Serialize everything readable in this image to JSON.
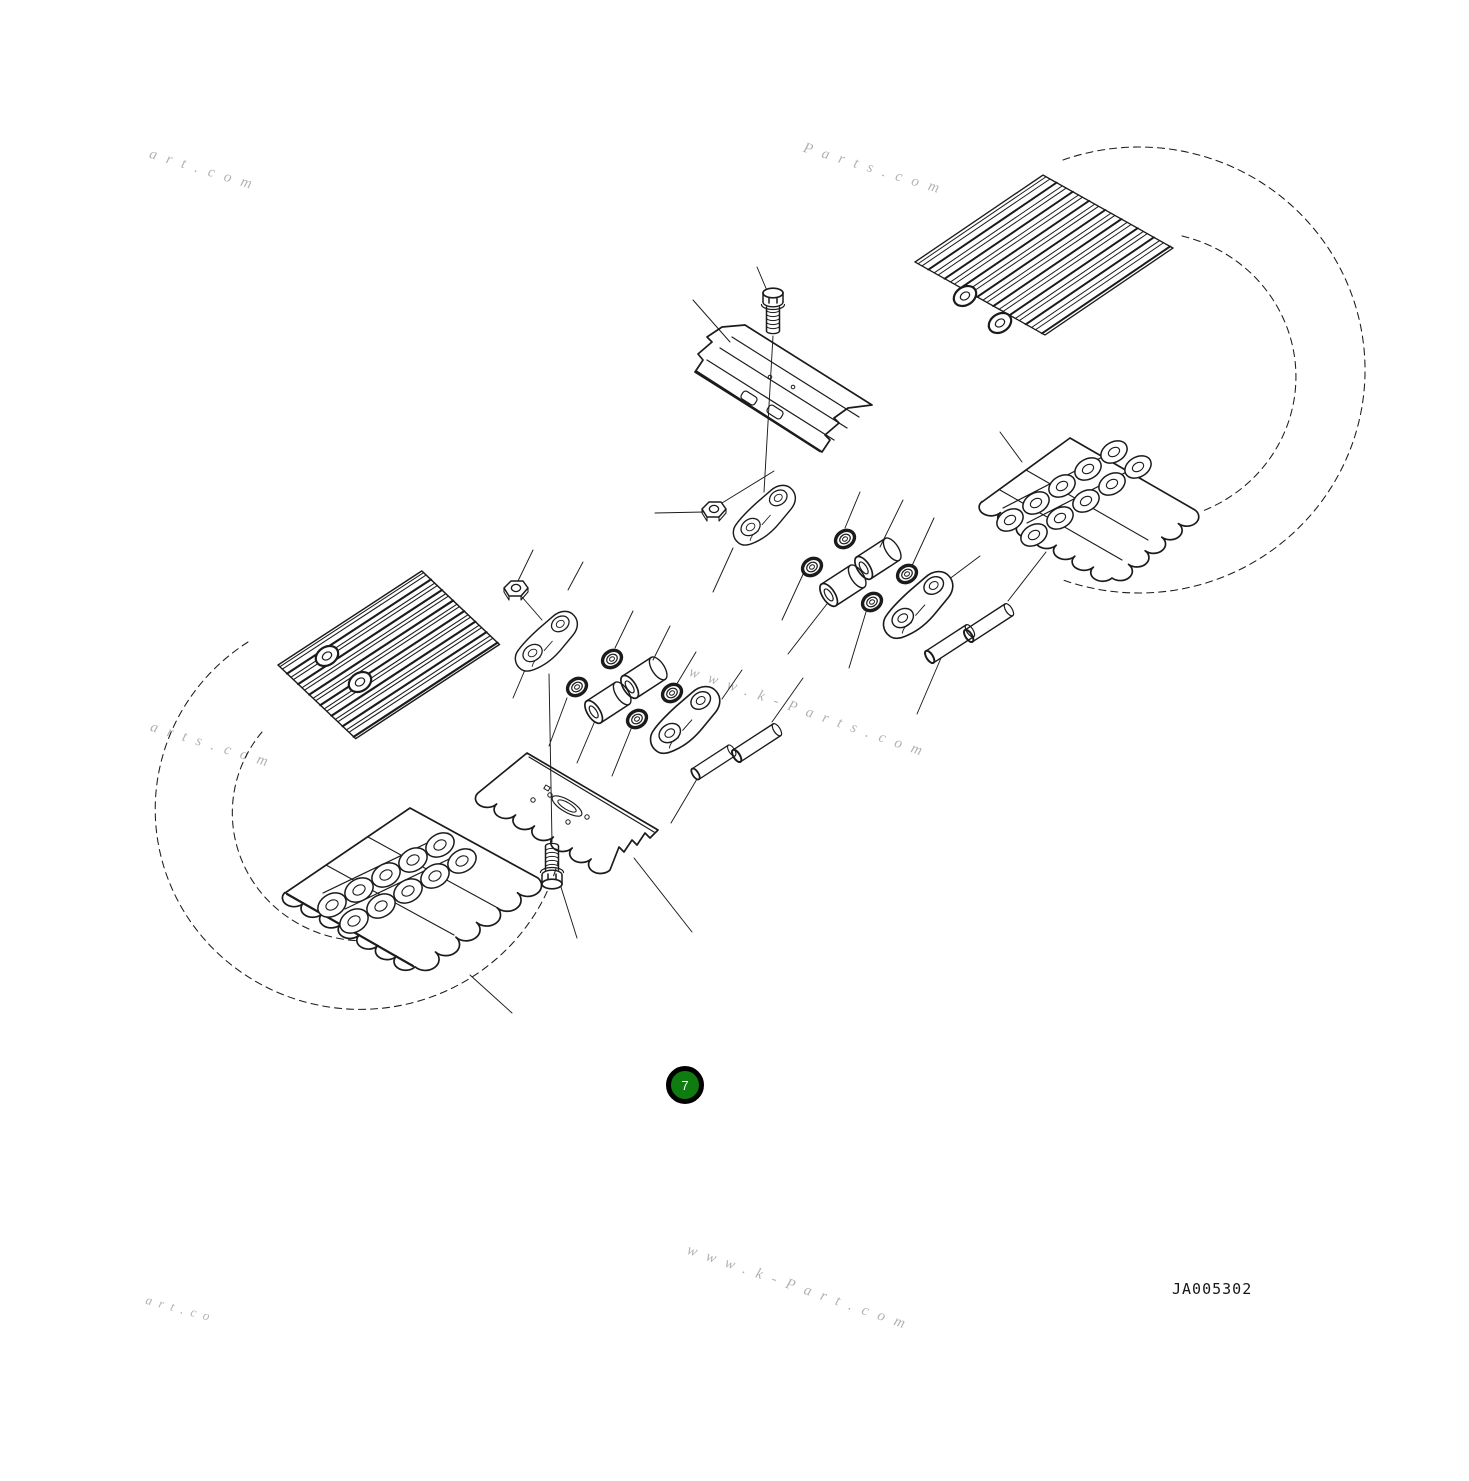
{
  "figure": {
    "code": "JA005302",
    "callout": {
      "number": "7",
      "fill_color": "#0f7c0f",
      "ring_color": "#000000",
      "number_color": "#ffffff"
    },
    "line_color": "#1b1b1b",
    "background_color": "#ffffff"
  },
  "watermarks": [
    {
      "text": "art.com"
    },
    {
      "text": "Parts.com"
    },
    {
      "text": "www.k-Parts.com"
    },
    {
      "text": "arts.com"
    },
    {
      "text": "www.k-Part.com"
    },
    {
      "text": "art.co"
    }
  ]
}
